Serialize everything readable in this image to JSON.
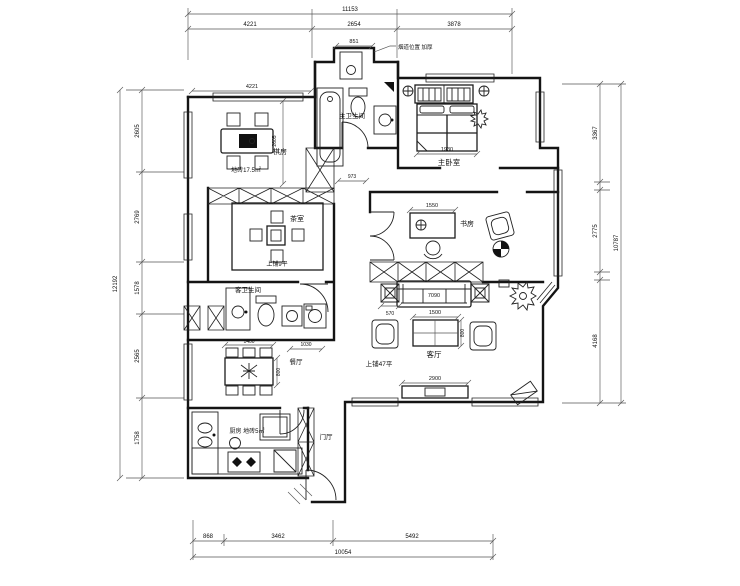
{
  "plan": {
    "note": "烟道位置 加厚",
    "dims": {
      "top": {
        "total": "11153",
        "segs": [
          "4221",
          "2654",
          "3878"
        ]
      },
      "bottom": {
        "total": "10054",
        "segs": [
          "868",
          "3462",
          "5492"
        ]
      },
      "left": {
        "total": "12192",
        "segs": [
          "2605",
          "2769",
          "1578",
          "2565",
          "1758"
        ]
      },
      "right": {
        "total": "10787",
        "segs": [
          "3367",
          "2775",
          "4168"
        ]
      }
    },
    "interior_dims": {
      "game_w": "4221",
      "game_h": "2605",
      "shaft_niche": "851",
      "hall": "973",
      "bed": "1930",
      "desk": "1550",
      "sofa": "7090",
      "side_table": "570",
      "coffee_w": "1500",
      "coffee_h": "800",
      "tv": "2900",
      "dining_w": "1400",
      "dining_h": "800",
      "bath_pass": "1030"
    },
    "rooms": {
      "game": {
        "name": "棋房",
        "area": "地砖17.5㎡"
      },
      "master_bath": {
        "name": "主卫生间"
      },
      "master_bed": {
        "name": "主卧室"
      },
      "tea": {
        "name": "茶室",
        "area": "上铺9平"
      },
      "study": {
        "name": "书房"
      },
      "guest_bath": {
        "name": "客卫生间"
      },
      "living": {
        "name": "客厅",
        "area": "上铺47平"
      },
      "dining": {
        "name": "餐厅"
      },
      "kitchen": {
        "name": "厨房 地砖5㎡"
      },
      "foyer": {
        "name": "门厅"
      }
    }
  }
}
